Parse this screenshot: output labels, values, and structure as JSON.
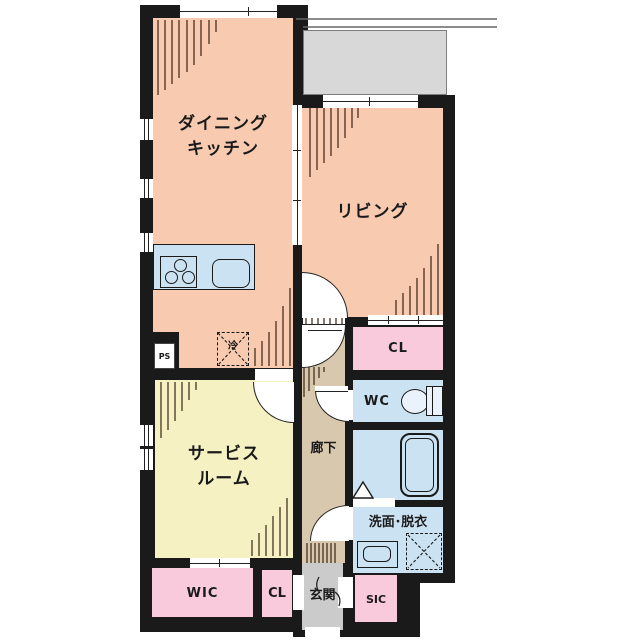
{
  "plan_title": "apartment-floor-plan",
  "colors": {
    "wall": "#1a1a1a",
    "room-salmon": "#f8cbb0",
    "room-yellow": "#f6f1c3",
    "room-pink": "#f9cadb",
    "room-blue": "#cbe2f3",
    "hall-beige": "#d8c9ae",
    "entrance-gray": "#cbcbcb",
    "balcony-gray": "#d8d8d8",
    "hatch-brown": "#3a2415"
  },
  "rooms": {
    "dining_kitchen": {
      "line1": "ダイニング",
      "line2": "キッチン"
    },
    "living": {
      "label": "リビング"
    },
    "service_room": {
      "line1": "サービス",
      "line2": "ルーム"
    },
    "hallway": {
      "label": "廊下"
    },
    "closet_top": {
      "label": "CL"
    },
    "toilet": {
      "label": "WC"
    },
    "washroom": {
      "label": "洗面･脱衣"
    },
    "walk_in_closet": {
      "label": "WIC"
    },
    "closet_bottom": {
      "label": "CL"
    },
    "entrance": {
      "label": "玄関"
    },
    "shoe_closet": {
      "label": "SIC"
    },
    "pipe_space": {
      "label": "PS"
    },
    "refrigerator": {
      "label": "冷"
    }
  }
}
